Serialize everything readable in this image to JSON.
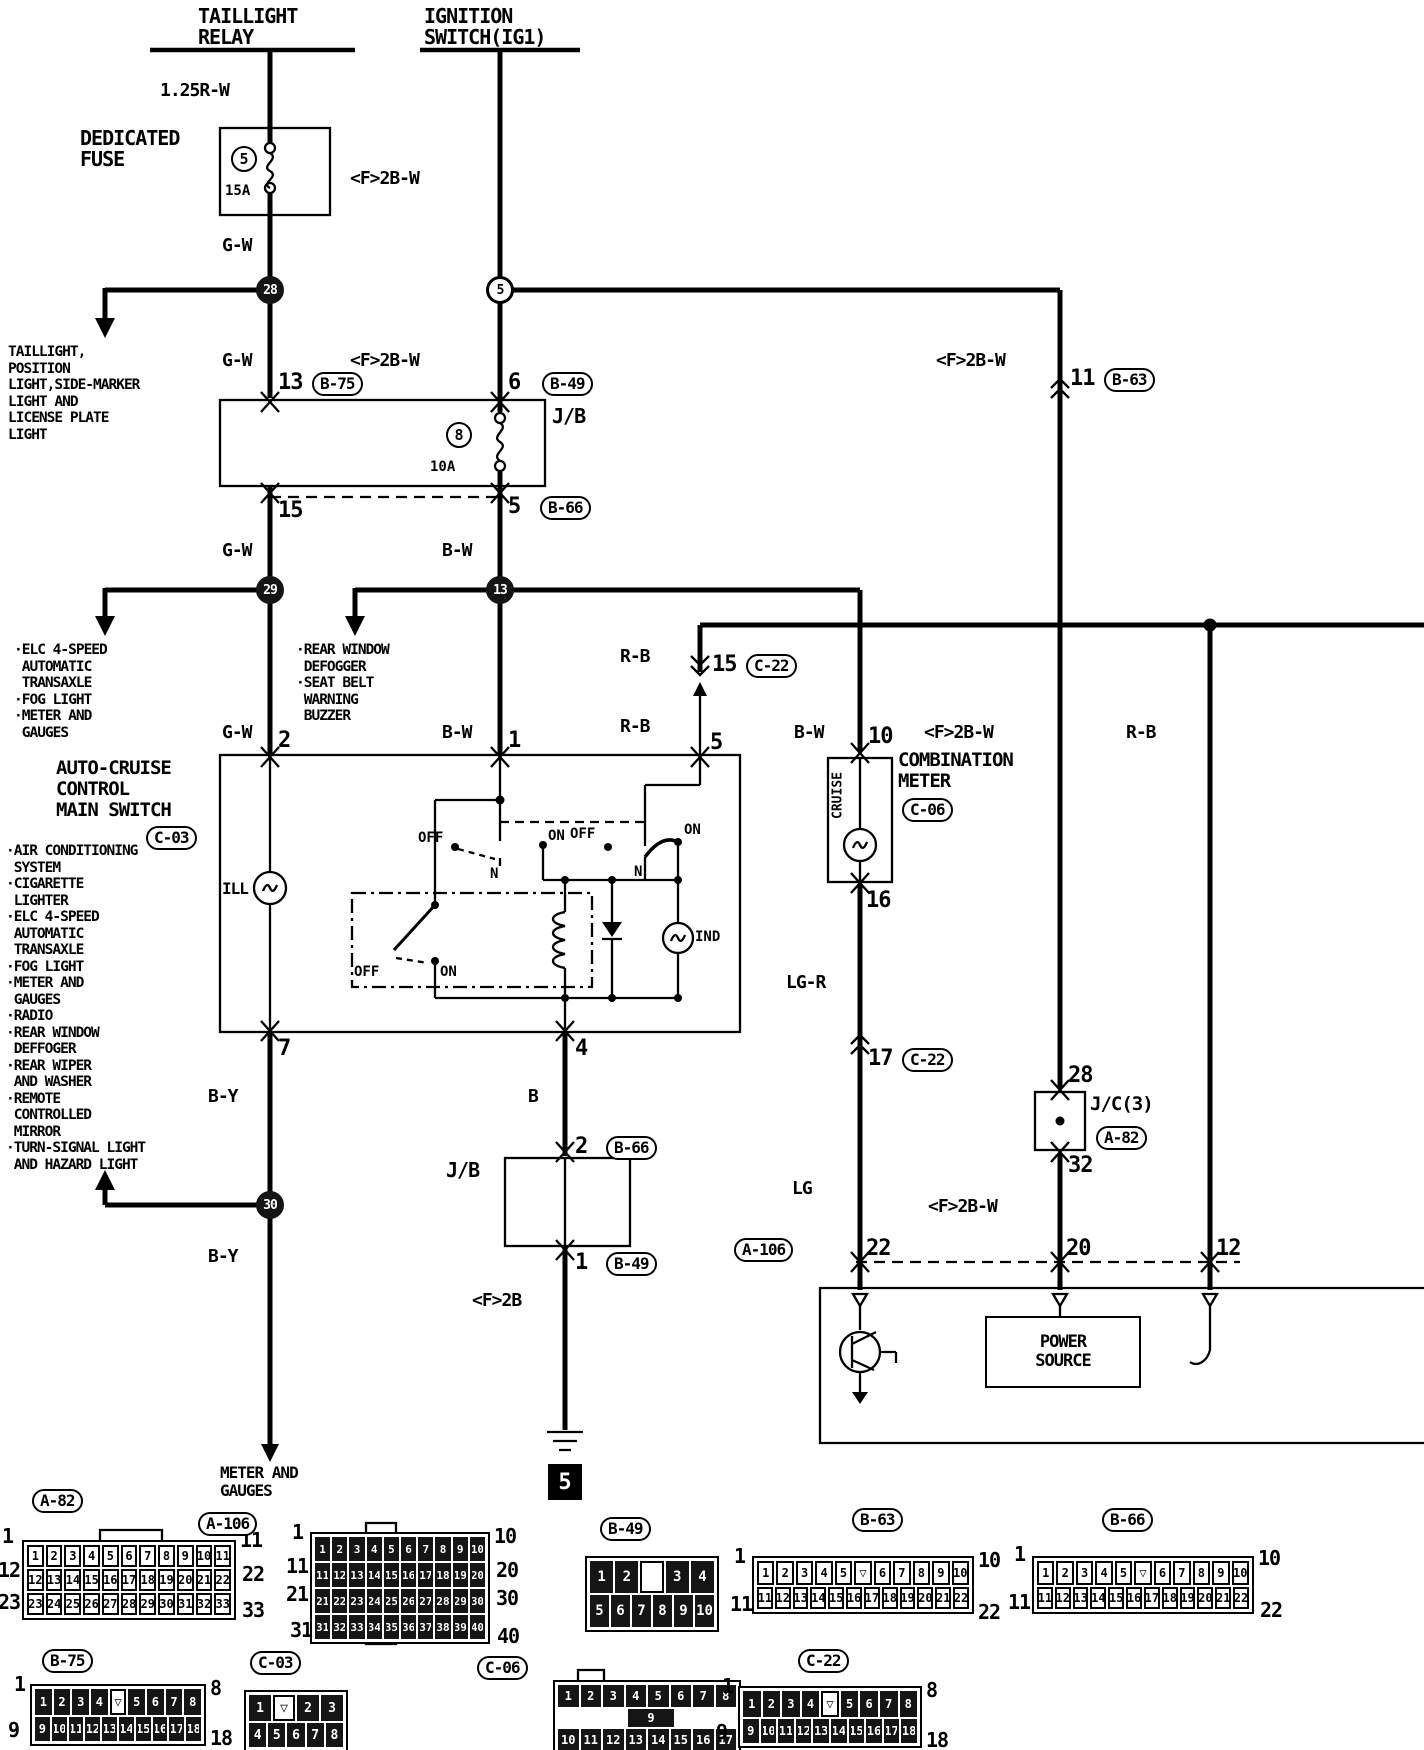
{
  "headers": {
    "taillight_relay": [
      "TAILLIGHT",
      "RELAY"
    ],
    "ignition_switch": [
      "IGNITION",
      "SWITCH(IG1)"
    ]
  },
  "wire_labels": {
    "w125rw": "1.25R-W",
    "gw1": "G-W",
    "gw2": "G-W",
    "gw3": "G-W",
    "gw4": "G-W",
    "f2bw1": "<F>2B-W",
    "f2bw2": "<F>2B-W",
    "f2bw3": "<F>2B-W",
    "f2bw4": "<F>2B-W",
    "f2bw5": "<F>2B-W",
    "f2b": "<F>2B",
    "bw1": "B-W",
    "bw2": "B-W",
    "bw3": "B-W",
    "rb1": "R-B",
    "rb2": "R-B",
    "rb3": "R-B",
    "by1": "B-Y",
    "by2": "B-Y",
    "lgr": "LG-R",
    "lg": "LG",
    "b": "B"
  },
  "components": {
    "dedicated_fuse": [
      "DEDICATED",
      "FUSE"
    ],
    "fuse1_num": "5",
    "fuse1_amp": "15A",
    "jb1": "J/B",
    "jb2": "J/B",
    "fuse2_num": "8",
    "fuse2_amp": "10A",
    "switch_title": [
      "AUTO-CRUISE",
      "CONTROL",
      "MAIN SWITCH"
    ],
    "switch_ref": "C-03",
    "meter_title": [
      "COMBINATION",
      "METER"
    ],
    "meter_ref": "C-06",
    "cruise": "CRUISE",
    "jc3": "J/C(3)",
    "jc3_ref": "A-82",
    "power_source": [
      "POWER",
      "SOURCE"
    ],
    "ill": "ILL",
    "ind": "IND",
    "off1": "OFF",
    "on1": "ON",
    "n1": "N",
    "off2": "OFF",
    "on2": "ON",
    "n2": "N",
    "off3": "OFF",
    "on3": "ON",
    "ground_ref": "5"
  },
  "nodes": {
    "n28": "28",
    "n5": "5",
    "n29": "29",
    "n13": "13",
    "n30": "30"
  },
  "pins": {
    "p13": "13",
    "p6": "6",
    "p15": "15",
    "p5jb": "5",
    "p11": "11",
    "p2": "2",
    "p1": "1",
    "p5sw": "5",
    "p7": "7",
    "p4": "4",
    "p10": "10",
    "p16": "16",
    "p15c22": "15",
    "p17": "17",
    "p28": "28",
    "p32": "32",
    "p22": "22",
    "p20": "20",
    "p12": "12",
    "p2b": "2",
    "p1b": "1"
  },
  "inline_refs": {
    "b75": "B-75",
    "b49a": "B-49",
    "b66a": "B-66",
    "b63": "B-63",
    "c22a": "C-22",
    "c22b": "C-22",
    "b66b": "B-66",
    "b49b": "B-49",
    "a106": "A-106",
    "a82": "A-82",
    "c06": "C-06"
  },
  "branch_texts": {
    "taillight_loads": [
      "TAILLIGHT,",
      "POSITION",
      "LIGHT,SIDE-MARKER",
      "LIGHT AND",
      "LICENSE PLATE",
      "LIGHT"
    ],
    "gw_loads": [
      "·ELC 4-SPEED",
      " AUTOMATIC",
      " TRANSAXLE",
      "·FOG LIGHT",
      "·METER AND",
      " GAUGES"
    ],
    "bw_loads": [
      "·REAR WINDOW",
      " DEFOGGER",
      "·SEAT BELT",
      " WARNING",
      " BUZZER"
    ],
    "sidebar": [
      "·AIR CONDITIONING",
      " SYSTEM",
      "·CIGARETTE",
      " LIGHTER",
      "·ELC 4-SPEED",
      " AUTOMATIC",
      " TRANSAXLE",
      "·FOG LIGHT",
      "·METER AND",
      " GAUGES",
      "·RADIO",
      "·REAR WINDOW",
      " DEFFOGER",
      "·REAR WIPER",
      " AND WASHER",
      "·REMOTE",
      " CONTROLLED",
      " MIRROR",
      "·TURN-SIGNAL LIGHT",
      " AND HAZARD LIGHT"
    ],
    "meter_gauges": [
      "METER AND",
      "GAUGES"
    ]
  },
  "connectors": {
    "a82": {
      "label": "A-82",
      "dark": false,
      "rows": [
        [
          "1",
          "2",
          "3",
          "4",
          "5",
          "6",
          "7",
          "8",
          "9",
          "10",
          "11"
        ],
        [
          "12",
          "13",
          "14",
          "15",
          "16",
          "17",
          "18",
          "19",
          "20",
          "21",
          "22"
        ],
        [
          "23",
          "24",
          "25",
          "26",
          "27",
          "28",
          "29",
          "30",
          "31",
          "32",
          "33"
        ]
      ],
      "corners": {
        "tl": "1",
        "tr": "11",
        "ml": "12",
        "mr": "22",
        "bl": "23",
        "br": "33"
      }
    },
    "a106": {
      "label": "A-106",
      "dark": true,
      "rows": [
        [
          "1",
          "2",
          "3",
          "4",
          "5",
          "6",
          "7",
          "8",
          "9",
          "10"
        ],
        [
          "11",
          "12",
          "13",
          "14",
          "15",
          "16",
          "17",
          "18",
          "19",
          "20"
        ],
        [
          "21",
          "22",
          "23",
          "24",
          "25",
          "26",
          "27",
          "28",
          "29",
          "30"
        ],
        [
          "31",
          "32",
          "33",
          "34",
          "35",
          "36",
          "37",
          "38",
          "39",
          "40"
        ]
      ],
      "corners": {
        "tl": "1",
        "tr": "10",
        "ml": "11",
        "mr": "20",
        "ml2": "21",
        "mr2": "30",
        "bl": "31",
        "br": "40"
      }
    },
    "b49": {
      "label": "B-49",
      "dark": true,
      "rows": [
        [
          "1",
          "2",
          "",
          "3",
          "4"
        ],
        [
          "5",
          "6",
          "7",
          "8",
          "9",
          "10"
        ]
      ],
      "corners": {}
    },
    "b63": {
      "label": "B-63",
      "dark": false,
      "rows": [
        [
          "1",
          "2",
          "3",
          "4",
          "5",
          "▽",
          "6",
          "7",
          "8",
          "9",
          "10"
        ],
        [
          "11",
          "12",
          "13",
          "14",
          "15",
          "16",
          "17",
          "18",
          "19",
          "20",
          "21",
          "22"
        ]
      ],
      "corners": {
        "tl": "1",
        "tr": "10",
        "bl": "11",
        "br": "22"
      }
    },
    "b66": {
      "label": "B-66",
      "dark": false,
      "rows": [
        [
          "1",
          "2",
          "3",
          "4",
          "5",
          "▽",
          "6",
          "7",
          "8",
          "9",
          "10"
        ],
        [
          "11",
          "12",
          "13",
          "14",
          "15",
          "16",
          "17",
          "18",
          "19",
          "20",
          "21",
          "22"
        ]
      ],
      "corners": {
        "tl": "1",
        "tr": "10",
        "bl": "11",
        "br": "22"
      }
    },
    "b75": {
      "label": "B-75",
      "dark": true,
      "rows": [
        [
          "1",
          "2",
          "3",
          "4",
          "▽",
          "5",
          "6",
          "7",
          "8"
        ],
        [
          "9",
          "10",
          "11",
          "12",
          "13",
          "14",
          "15",
          "16",
          "17",
          "18"
        ]
      ],
      "corners": {
        "tl": "1",
        "tr": "8",
        "bl": "9",
        "br": "18"
      }
    },
    "c03": {
      "label": "C-03",
      "dark": true,
      "rows": [
        [
          "1",
          "▽",
          "2",
          "3"
        ],
        [
          "4",
          "5",
          "6",
          "7",
          "8"
        ]
      ],
      "corners": {}
    },
    "c06": {
      "label": "C-06",
      "dark": true,
      "rows": [
        [
          "1",
          "2",
          "3",
          "4",
          "5",
          "6",
          "7",
          "8"
        ],
        [
          "9"
        ],
        [
          "10",
          "11",
          "12",
          "13",
          "14",
          "15",
          "16",
          "17"
        ]
      ],
      "corners": {}
    },
    "c22": {
      "label": "C-22",
      "dark": true,
      "rows": [
        [
          "1",
          "2",
          "3",
          "4",
          "▽",
          "5",
          "6",
          "7",
          "8"
        ],
        [
          "9",
          "10",
          "11",
          "12",
          "13",
          "14",
          "15",
          "16",
          "17",
          "18"
        ]
      ],
      "corners": {
        "tl": "1",
        "tr": "8",
        "bl": "9",
        "br": "18"
      }
    }
  }
}
